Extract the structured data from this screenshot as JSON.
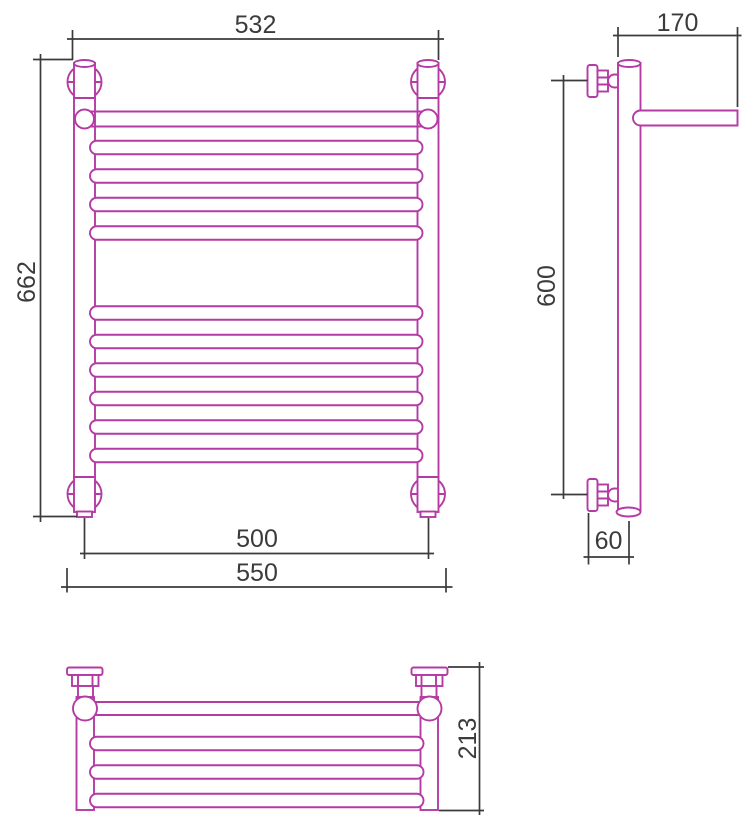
{
  "drawing": {
    "colors": {
      "outline": "#b43aa4",
      "dimension": "#3b3b3b",
      "background": "#ffffff"
    },
    "views": {
      "front": {
        "dims": {
          "width_top": "532",
          "height": "662",
          "axis_width": "500",
          "overall_width": "550"
        }
      },
      "side": {
        "dims": {
          "depth_top": "170",
          "height": "600",
          "wall_offset": "60"
        }
      },
      "plan": {
        "dims": {
          "depth": "213"
        }
      }
    }
  }
}
